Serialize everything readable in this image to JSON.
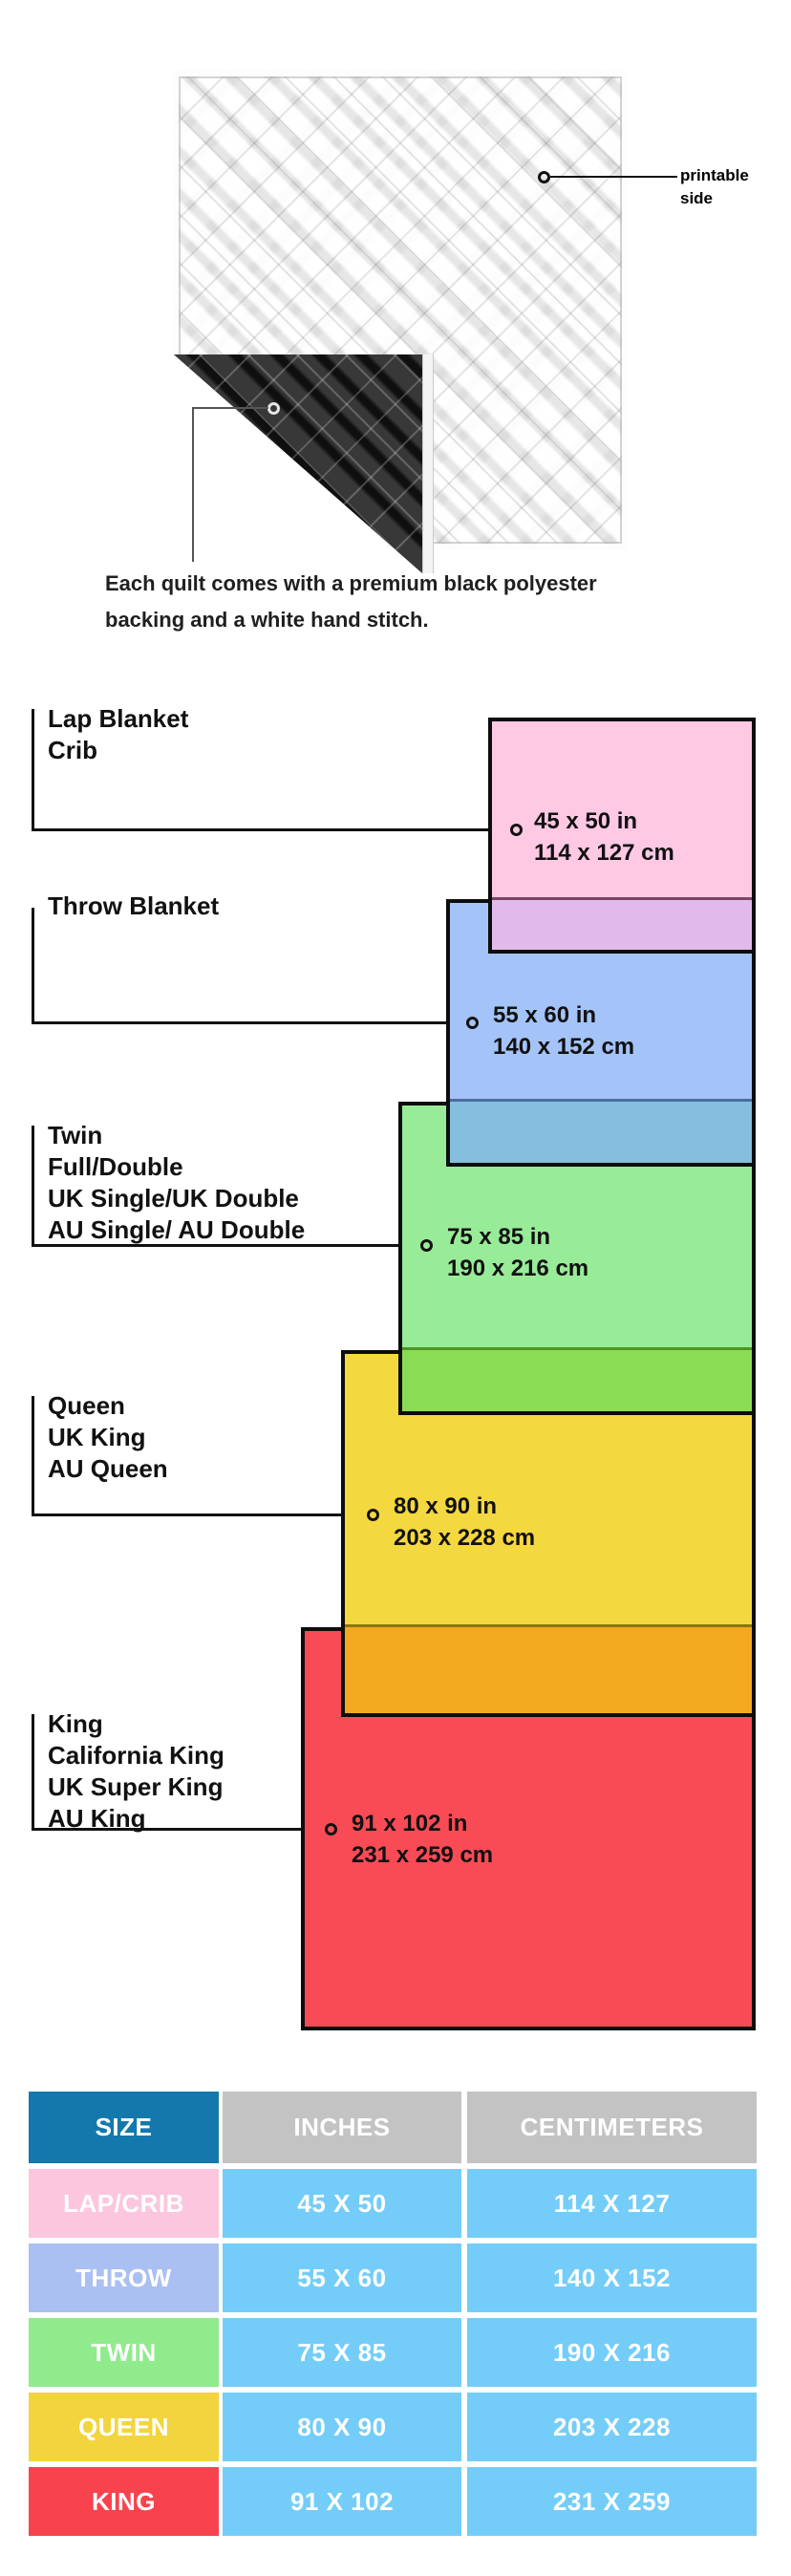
{
  "quilt": {
    "printable_label_line1": "printable",
    "printable_label_line2": "side",
    "caption_line1": "Each quilt comes with a premium black polyester",
    "caption_line2": "backing and a white hand stitch."
  },
  "diagram": {
    "groups": [
      {
        "labels": [
          "Lap Blanket",
          "Crib"
        ],
        "size_in": "45 x 50 in",
        "size_cm": "114 x 127 cm",
        "fill": "#FFC8E3",
        "overlap_fill": "#E2BAEA",
        "overlap_edge": "#7D4560"
      },
      {
        "labels": [
          "Throw Blanket"
        ],
        "size_in": "55 x 60 in",
        "size_cm": "140 x 152 cm",
        "fill": "#A4C3F9",
        "overlap_fill": "#85BEDE",
        "overlap_edge": "#4D6D9E"
      },
      {
        "labels": [
          "Twin",
          "Full/Double",
          "UK Single/UK Double",
          "AU Single/ AU Double"
        ],
        "size_in": "75 x 85 in",
        "size_cm": "190 x 216 cm",
        "fill": "#98EC98",
        "overlap_fill": "#8ADC55",
        "overlap_edge": "#4E9425"
      },
      {
        "labels": [
          "Queen",
          "UK King",
          "AU Queen"
        ],
        "size_in": "80 x 90 in",
        "size_cm": "203 x 228 cm",
        "fill": "#F4D83F",
        "overlap_fill": "#F2A81F",
        "overlap_edge": "#8A7410"
      },
      {
        "labels": [
          "King",
          "California King",
          "UK Super King",
          "AU King"
        ],
        "size_in": "91 x 102 in",
        "size_cm": "231 x 259 cm",
        "fill": "#F94B55"
      }
    ]
  },
  "table": {
    "header_bg_size": "#1478AC",
    "header_bg_metric": "#C3C3C3",
    "cell_bg": "#74CDF8",
    "headers": [
      {
        "label": "SIZE"
      },
      {
        "label": "INCHES"
      },
      {
        "label": "CENTIMETERS"
      }
    ],
    "rows": [
      {
        "size": "LAP/CRIB",
        "inches": "45 X 50",
        "cm": "114 X 127",
        "bg": "#FBC6DE"
      },
      {
        "size": "THROW",
        "inches": "55 X 60",
        "cm": "140 X 152",
        "bg": "#ABC0F2"
      },
      {
        "size": "TWIN",
        "inches": "75 X 85",
        "cm": "190 X 216",
        "bg": "#90EB8D"
      },
      {
        "size": "QUEEN",
        "inches": "80 X 90",
        "cm": "203 X 228",
        "bg": "#F2D53E"
      },
      {
        "size": "KING",
        "inches": "91 X 102",
        "cm": "231 X 259",
        "bg": "#F8434F"
      }
    ]
  }
}
